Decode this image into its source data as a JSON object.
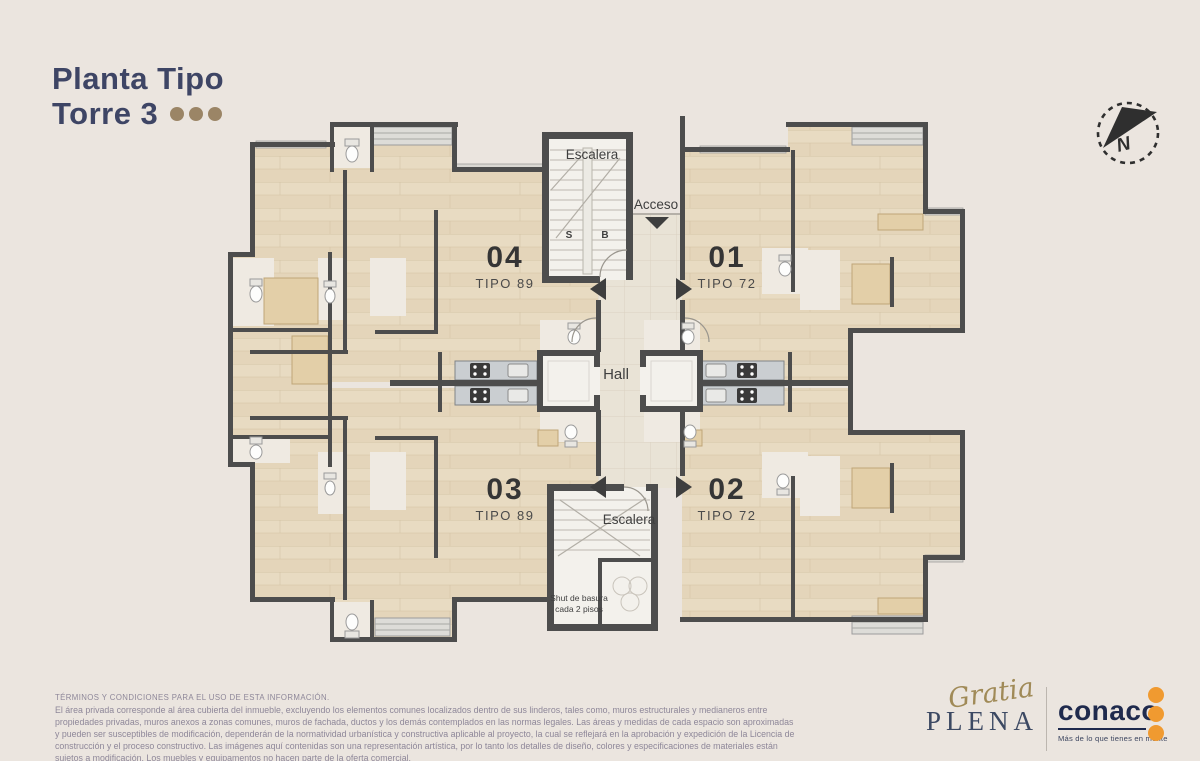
{
  "header": {
    "title_line1": "Planta Tipo",
    "title_line2": "Torre 3"
  },
  "compass": {
    "letter": "N"
  },
  "plan": {
    "stair_top_label": "Escalera",
    "stair_bottom_label": "Escalera",
    "stair_s": "S",
    "stair_b": "B",
    "access_label": "Acceso",
    "hall_label": "Hall",
    "chute_label": "Shut de basura cada 2 pisos",
    "units": [
      {
        "number": "04",
        "type": "TIPO 89"
      },
      {
        "number": "01",
        "type": "TIPO 72"
      },
      {
        "number": "03",
        "type": "TIPO 89"
      },
      {
        "number": "02",
        "type": "TIPO 72"
      }
    ]
  },
  "footer": {
    "terms_title": "TÉRMINOS Y CONDICIONES PARA EL USO DE ESTA INFORMACIÓN.",
    "terms_body": "El área privada corresponde al área cubierta del inmueble, excluyendo los elementos comunes localizados dentro de sus linderos, tales como, muros estructurales y medianeros entre propiedades privadas, muros anexos a zonas comunes, muros de fachada, ductos y los demás contemplados en las normas legales. Las áreas y medidas de cada espacio son aproximadas y pueden ser susceptibles de modificación, dependerán de la normatividad urbanística y constructiva aplicable al proyecto, la cual se reflejará en la aprobación y expedición de la Licencia de construcción y el proceso constructivo. Las imágenes aquí contenidas son una representación artística, por lo tanto los detalles de diseño, colores y especificaciones de materiales están sujetos a modificación. Los muebles y equipamentos no hacen parte de la oferta comercial.",
    "brand_script": "Gratia",
    "brand_name": "PLENA",
    "logo_name": "conaco",
    "logo_tagline": "Más de lo que tienes en mente"
  },
  "colors": {
    "background": "#ebe5df",
    "title_navy": "#3e4565",
    "accent_tan": "#9b8566",
    "wall_gray": "#4d4d4d",
    "wood_floor": "#e8dbc2",
    "corridor_tile": "#e9e3d6",
    "logo_navy": "#1f2a4d",
    "logo_orange": "#f09a30",
    "terms_gray": "#8e8799"
  }
}
